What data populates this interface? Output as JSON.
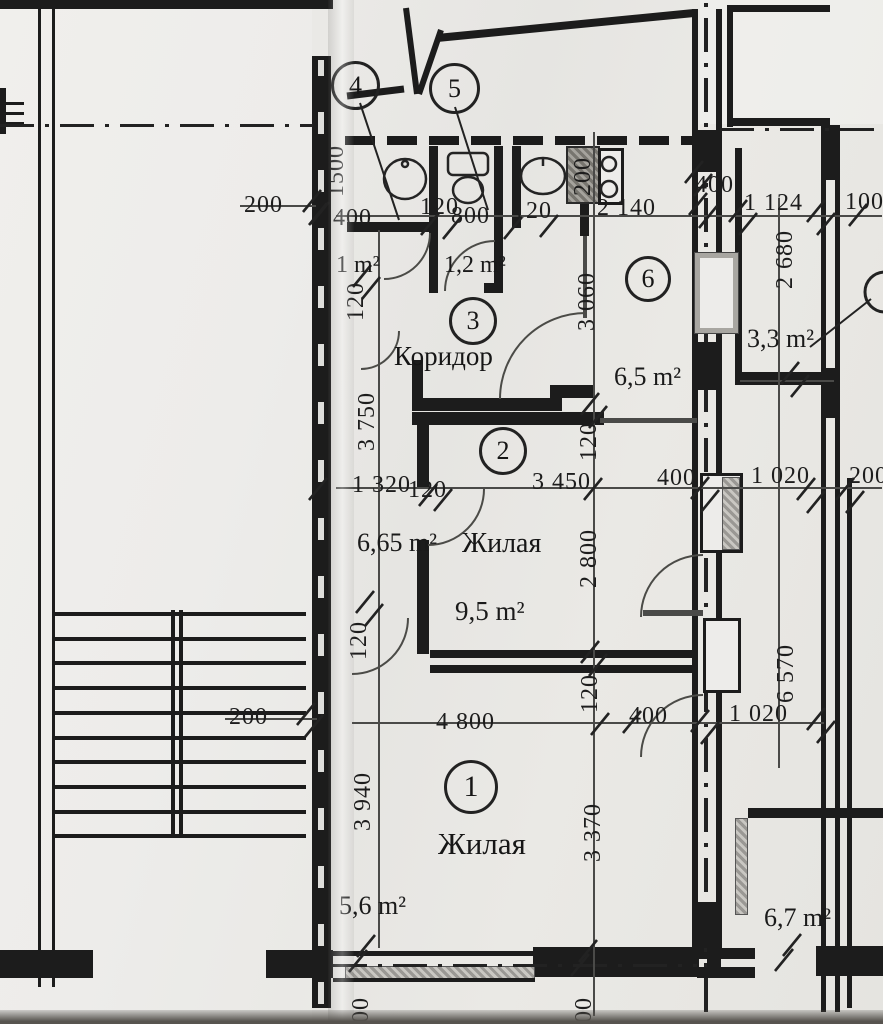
{
  "plan": {
    "title": "Floor plan (scanned blueprint)",
    "room_numbers": {
      "n1": "1",
      "n2": "2",
      "n3": "3",
      "n4": "4",
      "n5": "5",
      "n6": "6",
      "n7": ""
    },
    "room_names": {
      "corridor": "Коридор",
      "living2": "Жилая",
      "living1": "Жилая"
    },
    "areas": {
      "wc_small": "1 m²",
      "wc": "1,2 m²",
      "kitchen": "6,5 m²",
      "storage": "3,3 m²",
      "hall": "6,65 m²",
      "living2": "9,5 m²",
      "left_bottom": "5,6 m²",
      "right_bottom": "6,7 m²"
    },
    "dims_top": [
      "400",
      "120",
      "800",
      "120",
      "2 140",
      "400",
      "1 124",
      "100"
    ],
    "dims_mid": [
      "1 320",
      "120",
      "3 450",
      "400",
      "1 020",
      "200"
    ],
    "dims_row3": [
      "4 800",
      "400",
      "1 020"
    ],
    "dims_left": [
      "200",
      "200"
    ],
    "dims_vertical": [
      "1500",
      "120",
      "200",
      "3 060",
      "2 680",
      "3 750",
      "120",
      "2 800",
      "120",
      "120",
      "6 570",
      "3 940",
      "3 370",
      "00",
      "00"
    ],
    "ink_color": "#1c1c1c",
    "paper_color": "#e9e8e5"
  }
}
